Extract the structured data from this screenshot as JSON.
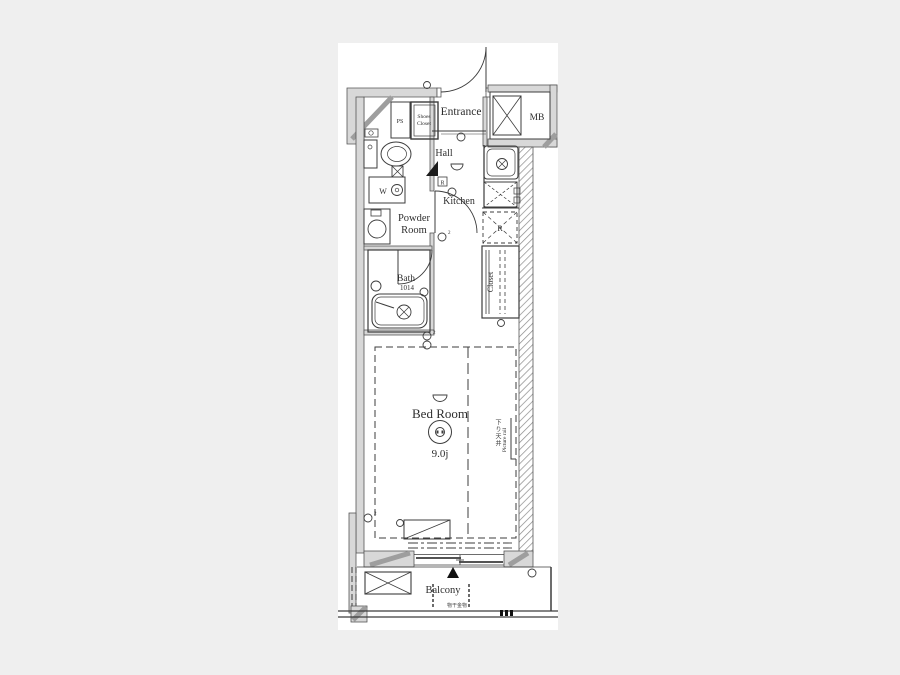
{
  "colors": {
    "background": "#efefef",
    "paper": "#ffffff",
    "wall_fill": "#d8d8d8",
    "line": "#3c3c3c",
    "hatch": "#8a8a8a"
  },
  "plan": {
    "entrance": {
      "label": "Entrance"
    },
    "hall": {
      "label": "Hall"
    },
    "kitchen": {
      "label": "Kitchen"
    },
    "powder_room": {
      "line1": "Powder",
      "line2": "Room"
    },
    "bath": {
      "label": "Bath",
      "size": "1014"
    },
    "closet": {
      "label": "Closet"
    },
    "bedroom": {
      "label": "Bed Room",
      "size": "9.0j",
      "ceiling_note": "下り天井",
      "picture_rail": "Picture rail"
    },
    "balcony": {
      "label": "Balcony",
      "laundry_hardware": "物干金物"
    },
    "entry": {
      "ps": "PS",
      "shoes_closet_line1": "Shoes",
      "shoes_closet_line2": "Closet",
      "meter_box": "MB"
    },
    "symbols": {
      "washer": "W",
      "refrigerator": "R",
      "wall_panel": "R",
      "outlet_sup": "2"
    }
  }
}
